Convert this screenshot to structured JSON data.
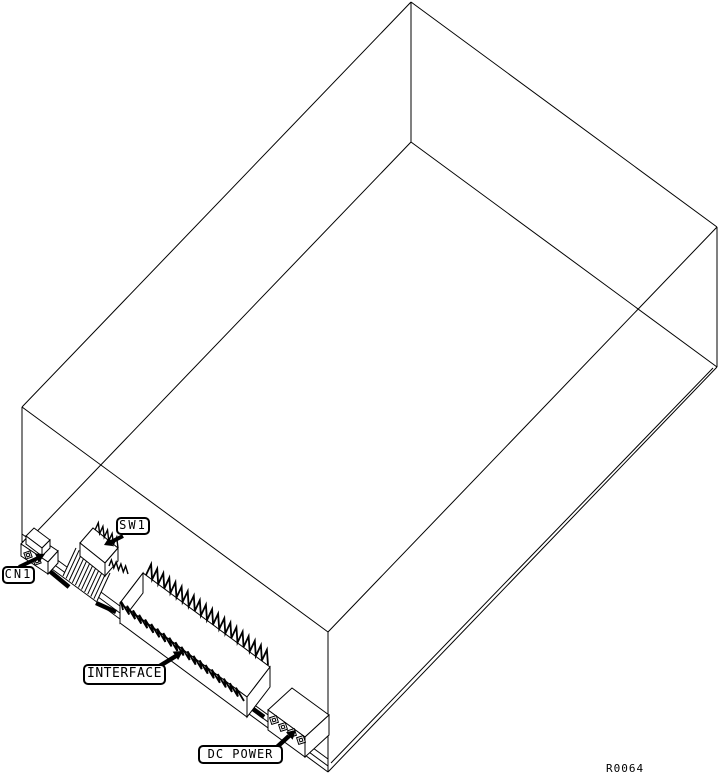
{
  "diagram": {
    "figure_id": "R0064",
    "callouts": {
      "cn1": "CN1",
      "sw1": "SW1",
      "interface": "INTERFACE",
      "dc_power": "DC POWER"
    },
    "colors": {
      "line": "#000000",
      "background": "#ffffff"
    }
  }
}
